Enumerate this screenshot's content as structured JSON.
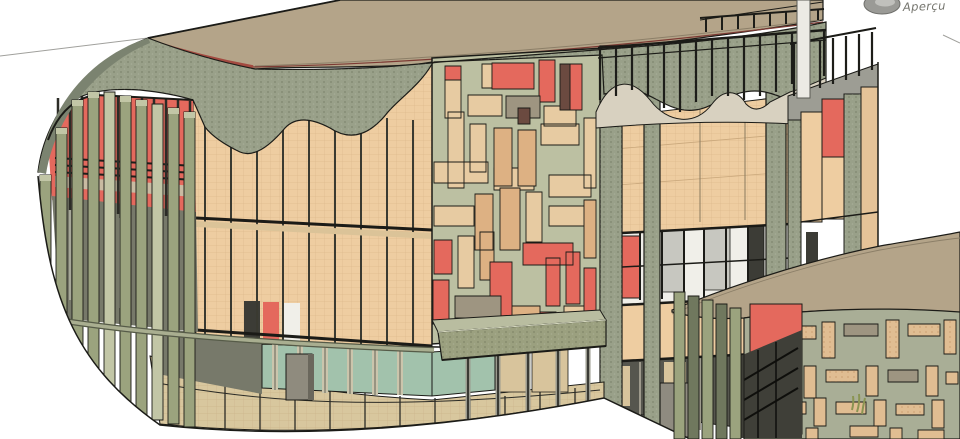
{
  "preview": {
    "label": "Aperçu",
    "icon": "navigation-wheel-icon"
  },
  "viewport": {
    "content": "3D shaded building model",
    "buildings": [
      "main-curved-building",
      "secondary-curved-building"
    ]
  },
  "palette": {
    "roof_tan": "#b4a489",
    "red_trim": "#a34a40",
    "olive_wall": "#99a089",
    "olive_dark": "#7b8370",
    "fin_green": "#9ba37e",
    "fin_light": "#c2c6a6",
    "red_accent": "#e4695d",
    "facade_tan": "#eecda1",
    "glass_white": "#f0efe9",
    "glass_gray": "#c7c7c0",
    "glass_dark": "#3c3c36",
    "glass_teal": "#a2c2ac",
    "base_tan": "#d8c79e",
    "canopy_olive": "#9ba07f",
    "mosaic_bg": "#bcc0a2",
    "mosaic_tan": "#e7cba2",
    "mosaic_peach": "#ddb183",
    "mosaic_gray": "#9e9581",
    "mosaic_dark": "#6b4a40",
    "mosaic2_bg": "#a9ae96",
    "mosaic2_tan": "#e0bd92",
    "parapet_light": "#d8d1c0",
    "interior_dim": "#77796a",
    "deck_light": "#c9bba2",
    "store_dark": "#56564e",
    "white_column": "#eceae4",
    "line": "#1b1b17",
    "guide": "#a0a09c",
    "text_gray": "#74746d"
  }
}
